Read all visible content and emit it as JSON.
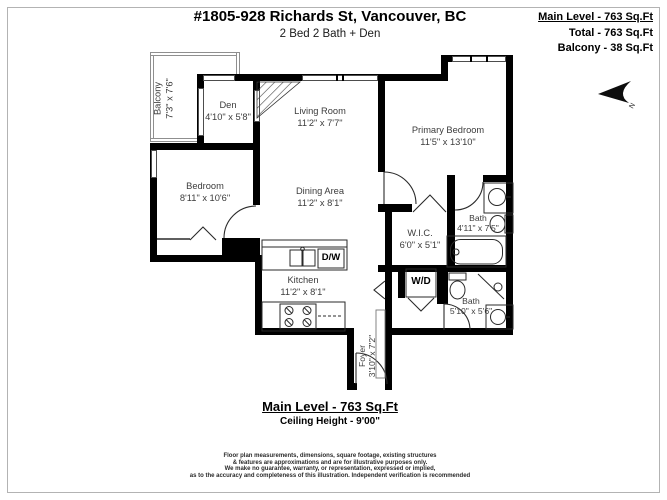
{
  "header": {
    "title": "#1805-928 Richards St, Vancouver, BC",
    "subtitle": "2 Bed 2 Bath + Den"
  },
  "area_summary": {
    "main_level": "Main Level - 763 Sq.Ft",
    "total": "Total - 763 Sq.Ft",
    "balcony": "Balcony - 38 Sq.Ft"
  },
  "rooms": {
    "balcony": {
      "name": "Balcony",
      "dims": "7'3\" x 7'6\""
    },
    "den": {
      "name": "Den",
      "dims": "4'10\" x 5'8\""
    },
    "living_room": {
      "name": "Living Room",
      "dims": "11'2\" x 7'7\""
    },
    "primary_bedroom": {
      "name": "Primary Bedroom",
      "dims": "11'5\" x 13'10\""
    },
    "bedroom": {
      "name": "Bedroom",
      "dims": "8'11\" x 10'6\""
    },
    "dining_area": {
      "name": "Dining Area",
      "dims": "11'2\" x 8'1\""
    },
    "wic": {
      "name": "W.I.C.",
      "dims": "6'0\" x 5'1\""
    },
    "bath_ensuite": {
      "name": "Bath",
      "dims": "4'11\" x 7'5\""
    },
    "kitchen": {
      "name": "Kitchen",
      "dims": "11'2\" x 8'1\""
    },
    "bath_main": {
      "name": "Bath",
      "dims": "5'10\" x 5'6\""
    },
    "foyer": {
      "name": "Foyer",
      "dims": "3'10\" x 7'2\""
    }
  },
  "appliances": {
    "dishwasher": "D/W",
    "washer_dryer": "W/D"
  },
  "compass": {
    "north": "N"
  },
  "footer": {
    "main_level": "Main Level - 763 Sq.Ft",
    "ceiling": "Ceiling Height - 9'00\"",
    "disclaimer_lines": [
      "Floor plan measurements, dimensions, square footage, existing structures",
      "& features are approximations and are for illustrative purposes only.",
      "We make no guarantee, warranty, or representation, expressed or implied,",
      "as to the accuracy and completeness of this illustration. Independent verification is recommended"
    ]
  },
  "colors": {
    "wall": "#000000",
    "label_text": "#3c3c3c",
    "balcony_rail": "#8f8f8f"
  }
}
